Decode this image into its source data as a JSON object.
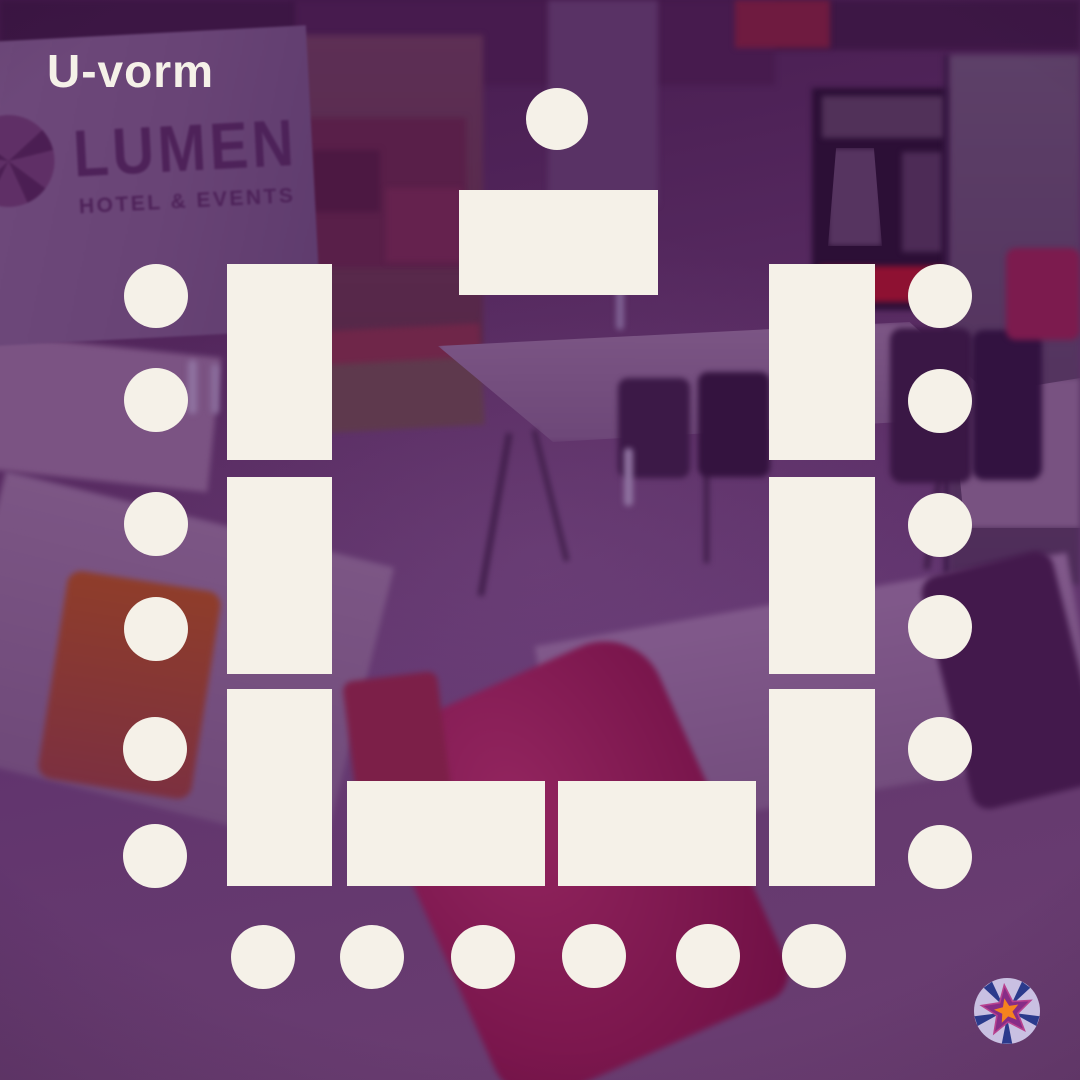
{
  "header": {
    "title": "U-vorm"
  },
  "colors": {
    "cream": "#f5f1e8",
    "backdrop_purple": "#53265c",
    "logo_lavender": "#c9c0e2",
    "logo_purple": "#872c87",
    "logo_orange": "#f5831f",
    "logo_navy": "#2b3a8c"
  },
  "photo": {
    "screen": {
      "wordmark": "LUMEN",
      "tagline": "HOTEL & EVENTS"
    }
  },
  "seating": {
    "arrangement": "u-shape",
    "table_count": 9,
    "chair_count": 19,
    "tables": [
      {
        "id": "head-table",
        "x": 459,
        "y": 190,
        "w": 199,
        "h": 105
      },
      {
        "id": "left-table-1",
        "x": 227,
        "y": 264,
        "w": 105,
        "h": 196
      },
      {
        "id": "left-table-2",
        "x": 227,
        "y": 477,
        "w": 105,
        "h": 197
      },
      {
        "id": "left-table-3",
        "x": 227,
        "y": 689,
        "w": 105,
        "h": 197
      },
      {
        "id": "right-table-1",
        "x": 769,
        "y": 264,
        "w": 106,
        "h": 196
      },
      {
        "id": "right-table-2",
        "x": 769,
        "y": 477,
        "w": 106,
        "h": 197
      },
      {
        "id": "right-table-3",
        "x": 769,
        "y": 689,
        "w": 106,
        "h": 197
      },
      {
        "id": "bottom-table-1",
        "x": 347,
        "y": 781,
        "w": 198,
        "h": 105
      },
      {
        "id": "bottom-table-2",
        "x": 558,
        "y": 781,
        "w": 198,
        "h": 105
      }
    ],
    "chairs": [
      {
        "id": "head-chair",
        "cx": 557,
        "cy": 119,
        "r": 31
      },
      {
        "id": "left-chair-1",
        "cx": 156,
        "cy": 296,
        "r": 32
      },
      {
        "id": "left-chair-2",
        "cx": 156,
        "cy": 400,
        "r": 32
      },
      {
        "id": "left-chair-3",
        "cx": 156,
        "cy": 524,
        "r": 32
      },
      {
        "id": "left-chair-4",
        "cx": 156,
        "cy": 629,
        "r": 32
      },
      {
        "id": "left-chair-5",
        "cx": 155,
        "cy": 749,
        "r": 32
      },
      {
        "id": "left-chair-6",
        "cx": 155,
        "cy": 856,
        "r": 32
      },
      {
        "id": "right-chair-1",
        "cx": 940,
        "cy": 296,
        "r": 32
      },
      {
        "id": "right-chair-2",
        "cx": 940,
        "cy": 401,
        "r": 32
      },
      {
        "id": "right-chair-3",
        "cx": 940,
        "cy": 525,
        "r": 32
      },
      {
        "id": "right-chair-4",
        "cx": 940,
        "cy": 627,
        "r": 32
      },
      {
        "id": "right-chair-5",
        "cx": 940,
        "cy": 749,
        "r": 32
      },
      {
        "id": "right-chair-6",
        "cx": 940,
        "cy": 857,
        "r": 32
      },
      {
        "id": "bottom-chair-1",
        "cx": 263,
        "cy": 957,
        "r": 32
      },
      {
        "id": "bottom-chair-2",
        "cx": 372,
        "cy": 957,
        "r": 32
      },
      {
        "id": "bottom-chair-3",
        "cx": 483,
        "cy": 957,
        "r": 32
      },
      {
        "id": "bottom-chair-4",
        "cx": 594,
        "cy": 956,
        "r": 32
      },
      {
        "id": "bottom-chair-5",
        "cx": 708,
        "cy": 956,
        "r": 32
      },
      {
        "id": "bottom-chair-6",
        "cx": 814,
        "cy": 956,
        "r": 32
      }
    ]
  },
  "branding": {
    "corner_logo": "lumen-star-logo"
  }
}
